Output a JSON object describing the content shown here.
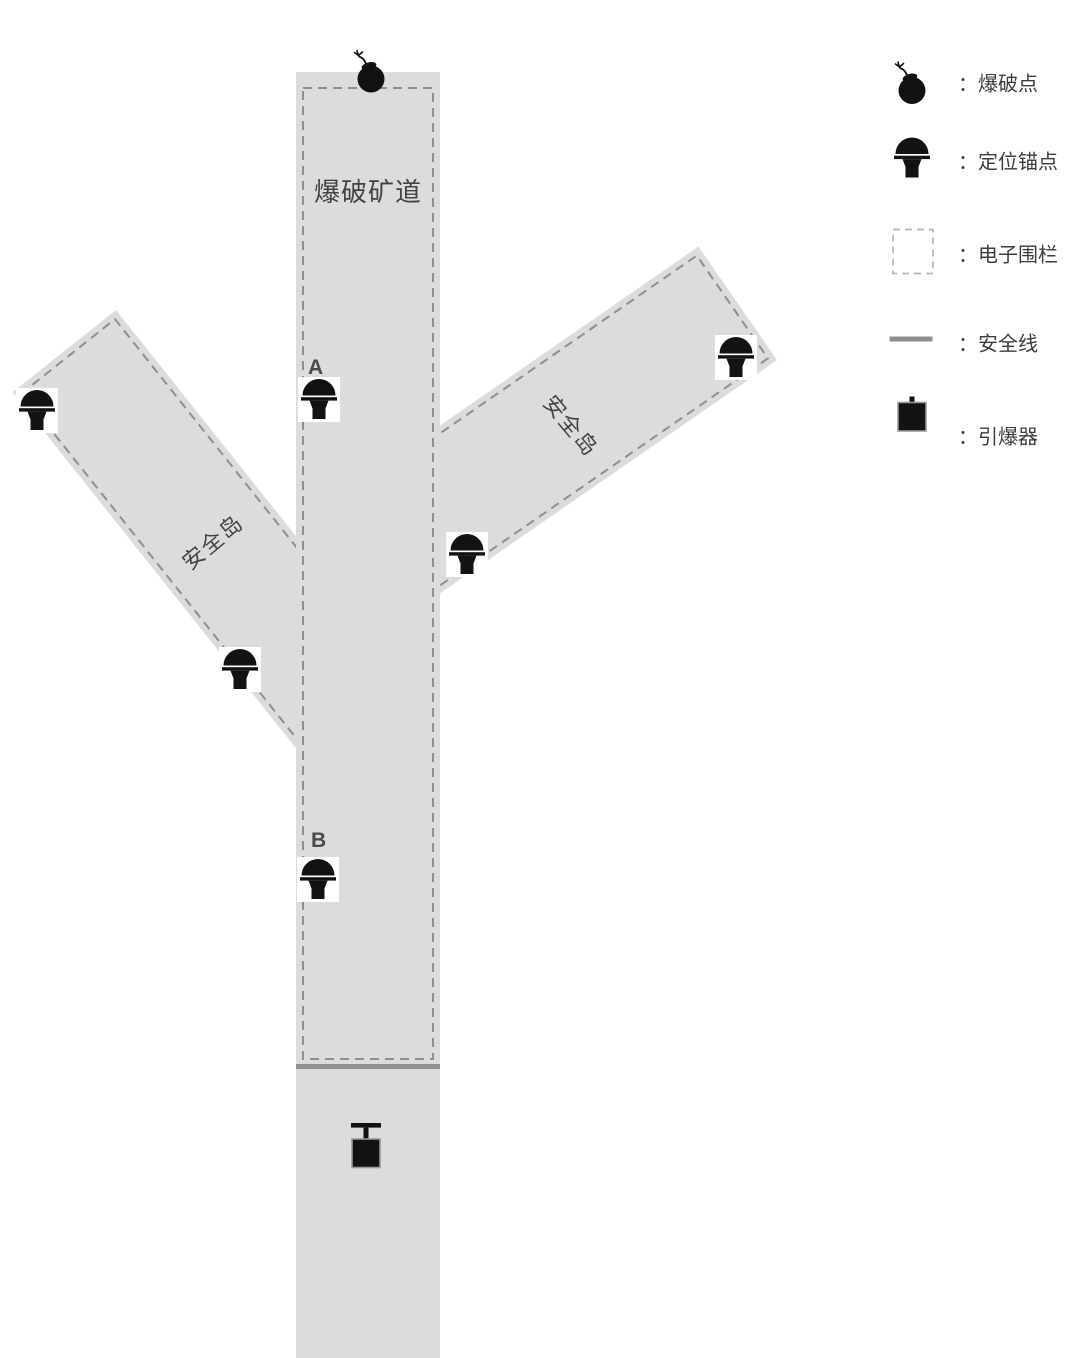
{
  "diagram": {
    "tunnel_label": "爆破矿道",
    "branch_left_label": "安全岛",
    "branch_right_label": "安全岛",
    "anchor_a_label": "A",
    "anchor_b_label": "B"
  },
  "legend": {
    "items": [
      {
        "icon": "bomb-icon",
        "label": "：爆破点"
      },
      {
        "icon": "anchor-icon",
        "label": "：定位锚点"
      },
      {
        "icon": "fence-icon",
        "label": "：电子围栏"
      },
      {
        "icon": "safety-line-icon",
        "label": "：安全线"
      },
      {
        "icon": "detonator-icon",
        "label": "：引爆器"
      }
    ]
  },
  "colors": {
    "tunnel_fill": "#dcdcdc",
    "fence_dash": "#8f8f8f",
    "legend_fence_dash": "#b8b8b8",
    "safety_line": "#8f8f8f",
    "icon_black": "#121212",
    "text": "#414141"
  }
}
